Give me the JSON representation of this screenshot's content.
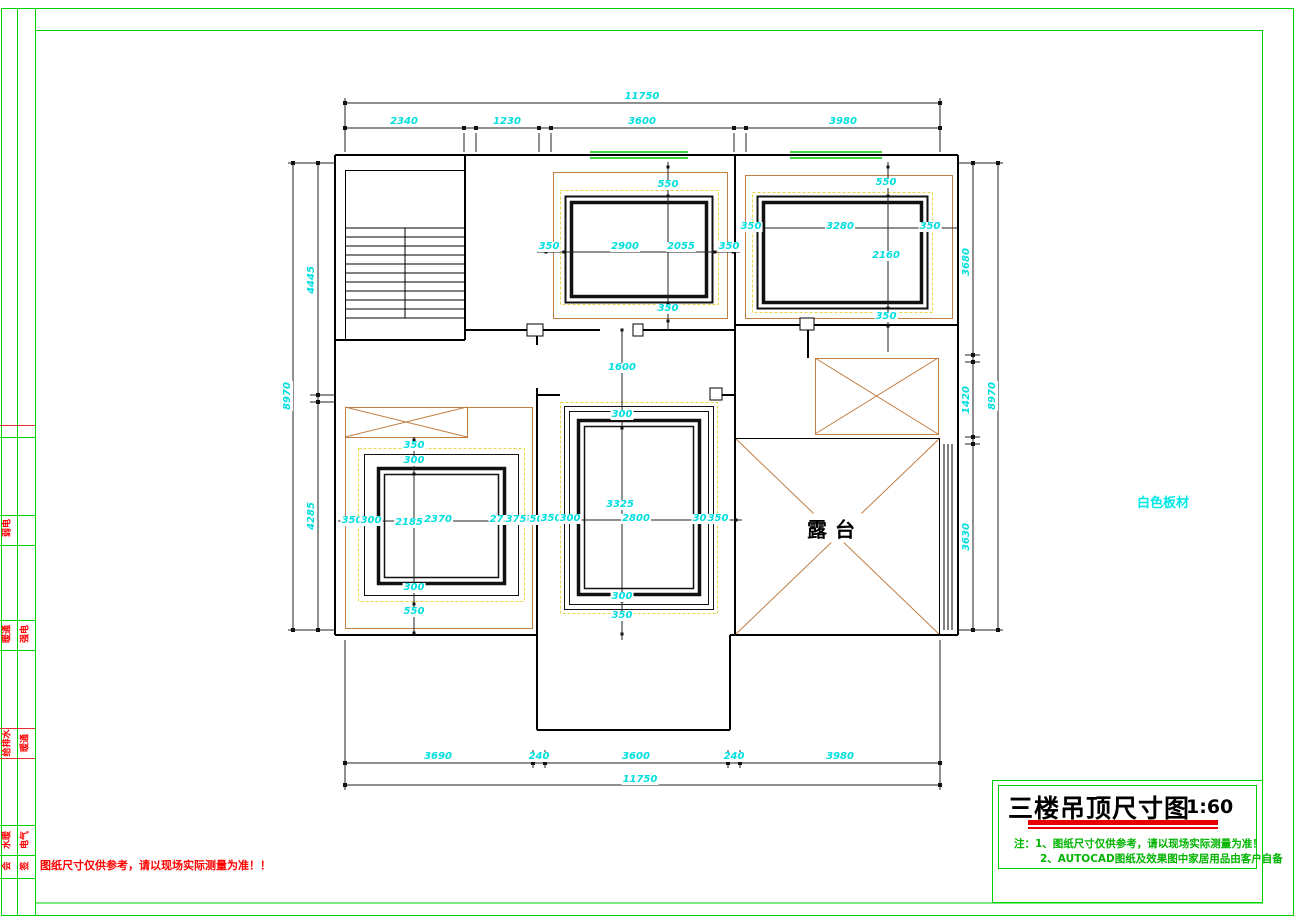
{
  "sheet": {
    "side_note": "白色板材",
    "bottom_note": "图纸尺寸仅供参考，请以现场实际测量为准！！"
  },
  "title_block": {
    "title": "三楼吊顶尺寸图",
    "scale": "1:60",
    "note1": "注：1、图纸尺寸仅供参考，请以现场实际测量为准！",
    "note2": "2、AUTOCAD图纸及效果图中家居用品由客户自备"
  },
  "signoff_strip": {
    "labels": [
      {
        "t": "弱电",
        "x": 8,
        "y": 528
      },
      {
        "t": "暖通",
        "x": 8,
        "y": 634
      },
      {
        "t": "强电",
        "x": 26,
        "y": 634
      },
      {
        "t": "给排水",
        "x": 8,
        "y": 743
      },
      {
        "t": "暖通",
        "x": 26,
        "y": 743
      },
      {
        "t": "水暖",
        "x": 8,
        "y": 840
      },
      {
        "t": "电气",
        "x": 26,
        "y": 840
      },
      {
        "t": "会",
        "x": 8,
        "y": 866
      },
      {
        "t": "签",
        "x": 26,
        "y": 866
      }
    ]
  },
  "plan": {
    "terrace_label": "露台",
    "dimensions": [
      {
        "t": "11750",
        "x": 642,
        "y": 97
      },
      {
        "t": "2340",
        "x": 404,
        "y": 122
      },
      {
        "t": "1230",
        "x": 507,
        "y": 122
      },
      {
        "t": "3600",
        "x": 642,
        "y": 122
      },
      {
        "t": "3980",
        "x": 843,
        "y": 122
      },
      {
        "t": "3690",
        "x": 438,
        "y": 757
      },
      {
        "t": "240",
        "x": 539,
        "y": 757
      },
      {
        "t": "3600",
        "x": 636,
        "y": 757
      },
      {
        "t": "240",
        "x": 734,
        "y": 757
      },
      {
        "t": "3980",
        "x": 840,
        "y": 757
      },
      {
        "t": "11750",
        "x": 640,
        "y": 780
      },
      {
        "t": "4445",
        "x": 312,
        "y": 280,
        "r": 1
      },
      {
        "t": "4285",
        "x": 312,
        "y": 516,
        "r": 1
      },
      {
        "t": "8970",
        "x": 288,
        "y": 396,
        "r": 1
      },
      {
        "t": "3680",
        "x": 967,
        "y": 262,
        "r": 1
      },
      {
        "t": "1420",
        "x": 967,
        "y": 400,
        "r": 1
      },
      {
        "t": "3630",
        "x": 967,
        "y": 537,
        "r": 1
      },
      {
        "t": "8970",
        "x": 993,
        "y": 396,
        "r": 1
      },
      {
        "t": "550",
        "x": 668,
        "y": 185
      },
      {
        "t": "350",
        "x": 549,
        "y": 247
      },
      {
        "t": "2900",
        "x": 625,
        "y": 247
      },
      {
        "t": "2055",
        "x": 681,
        "y": 247
      },
      {
        "t": "350",
        "x": 729,
        "y": 247
      },
      {
        "t": "350",
        "x": 668,
        "y": 309
      },
      {
        "t": "550",
        "x": 886,
        "y": 183
      },
      {
        "t": "350",
        "x": 751,
        "y": 227
      },
      {
        "t": "3280",
        "x": 840,
        "y": 227
      },
      {
        "t": "350",
        "x": 930,
        "y": 227
      },
      {
        "t": "2160",
        "x": 886,
        "y": 256
      },
      {
        "t": "350",
        "x": 886,
        "y": 317
      },
      {
        "t": "1600",
        "x": 622,
        "y": 368
      },
      {
        "t": "300",
        "x": 622,
        "y": 415
      },
      {
        "t": "3325",
        "x": 620,
        "y": 505
      },
      {
        "t": "550",
        "x": 533,
        "y": 520
      },
      {
        "t": "350",
        "x": 551,
        "y": 519
      },
      {
        "t": "300",
        "x": 570,
        "y": 519
      },
      {
        "t": "2800",
        "x": 636,
        "y": 519
      },
      {
        "t": "300",
        "x": 703,
        "y": 519
      },
      {
        "t": "350",
        "x": 718,
        "y": 519
      },
      {
        "t": "300",
        "x": 622,
        "y": 597
      },
      {
        "t": "350",
        "x": 622,
        "y": 616
      },
      {
        "t": "350",
        "x": 414,
        "y": 446
      },
      {
        "t": "300",
        "x": 414,
        "y": 461
      },
      {
        "t": "2185",
        "x": 409,
        "y": 523
      },
      {
        "t": "350",
        "x": 352,
        "y": 521
      },
      {
        "t": "300",
        "x": 371,
        "y": 521
      },
      {
        "t": "2370",
        "x": 438,
        "y": 520
      },
      {
        "t": "275",
        "x": 500,
        "y": 520
      },
      {
        "t": "375",
        "x": 516,
        "y": 520
      },
      {
        "t": "300",
        "x": 414,
        "y": 588
      },
      {
        "t": "550",
        "x": 414,
        "y": 612
      }
    ]
  },
  "colors": {
    "dimension_cyan": "#00dede",
    "frame_green": "#00d400",
    "alert_red": "#ff0000",
    "ceiling_orange": "#c17d42",
    "dashed_yellow": "#e8d840"
  }
}
